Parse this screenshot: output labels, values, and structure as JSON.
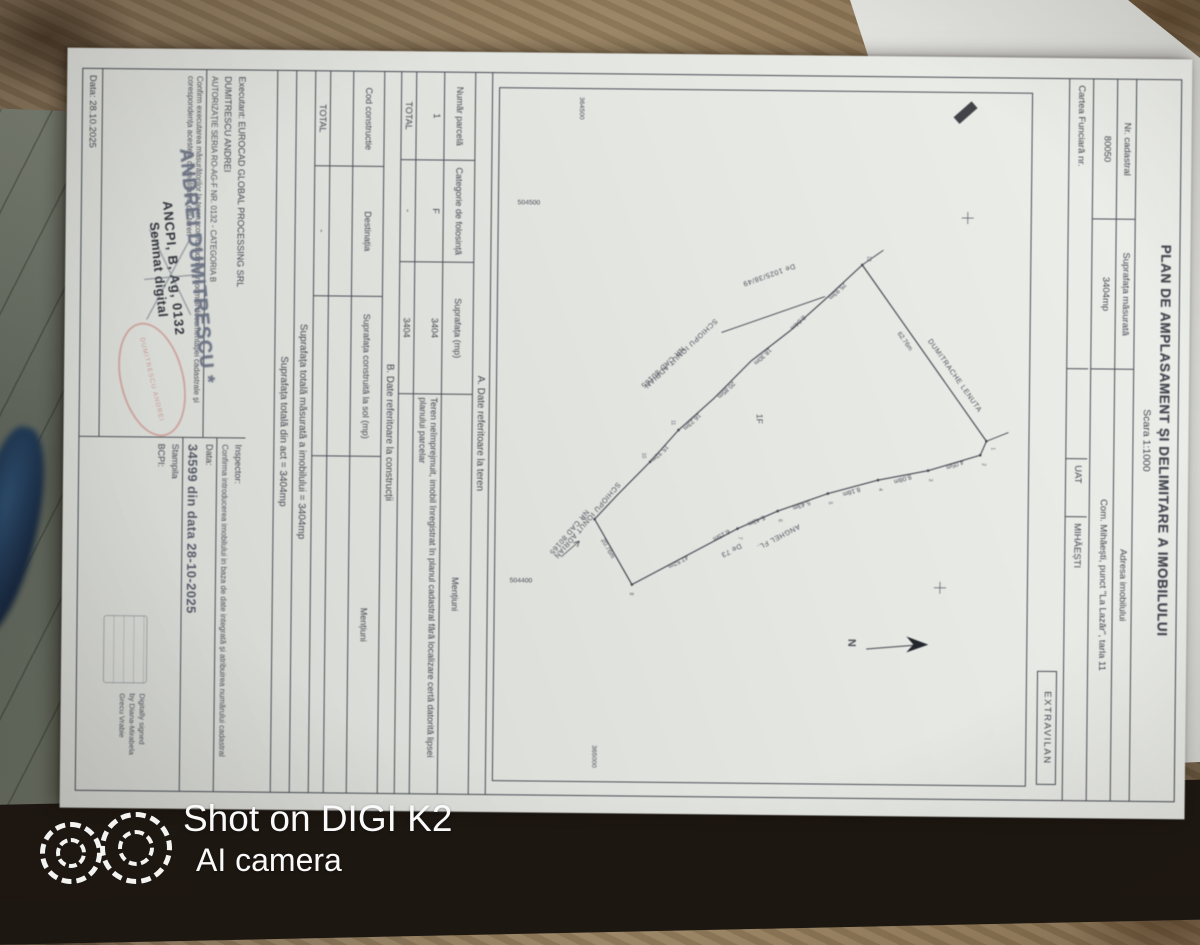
{
  "photo": {
    "watermark_line1": "Shot on DIGI K2",
    "watermark_line2": "AI  camera"
  },
  "doc": {
    "title": "PLAN DE AMPLASAMENT ȘI DELIMITARE A IMOBILULUI",
    "scale": "Scara 1:1000",
    "header": {
      "nr_cadastral_label": "Nr. cadastral",
      "nr_cadastral_value": "80050",
      "suprafata_label": "Suprafața măsurată",
      "suprafata_value": "3404mp",
      "adresa_label": "Adresa imobilului",
      "adresa_value": "Com. Mihăești, punct \"La Lazăr\", tarla 11",
      "cf_label": "Cartea Funciară nr.",
      "uat_label": "UAT",
      "uat_value": "MIHĂEȘTI",
      "zona": "EXTRAVILAN"
    },
    "plan": {
      "north": "N",
      "parcel": "1F",
      "grid_nw": "504500",
      "grid_sw": "504400",
      "grid_e": "365000",
      "grid_w": "364500",
      "road_label": "De 1025/38/49",
      "road2_label": "De 73",
      "neighbor_top": "DUMITRACHE LENUTA",
      "neighbor_left1": "SCHIOPU IONUT ADRIAN",
      "neighbor_left2": "NR CAD 80165",
      "neighbor_bottom1": "SCHIOPU IONUT ADRIAN",
      "neighbor_bottom2": "NR CAD 80165",
      "neighbor_south": "ANGHEL FL.",
      "dim_top": "62.76m",
      "dim_bottom": "20.76m",
      "dims_left": [
        "25.93m",
        "8.04m",
        "18.30m",
        "20.85m",
        "16.23m",
        "15.32m"
      ],
      "dims_right": [
        "4.05m",
        "8.08m",
        "8.18m",
        "5.43m",
        "5.43m",
        "6.15m",
        "47.52m"
      ],
      "vertex_numbers": [
        "1",
        "2",
        "3",
        "4",
        "5",
        "6",
        "7",
        "8",
        "9",
        "10",
        "11",
        "12"
      ]
    },
    "tableA": {
      "caption": "A. Date referitoare la teren",
      "col1": "Număr parcelă",
      "col2": "Categorie de folosință",
      "col3": "Suprafața (mp)",
      "col4": "Mențiuni",
      "row1_c1": "1",
      "row1_c2": "F",
      "row1_c3": "3404",
      "row1_c4": "Teren neîmprejmuit, imobil înregistrat în planul cadastral fără localizare certă datorită lipsei planului parcelar",
      "total_label": "TOTAL",
      "total_dash": "-",
      "total_value": "3404"
    },
    "tableB": {
      "caption": "B. Date referitoare la construcții",
      "col1": "Cod constructie",
      "col2": "Destinația",
      "col3": "Suprafața construită la sol (mp)",
      "col4": "Mențiuni",
      "total_label": "TOTAL",
      "total_dash": "-"
    },
    "totals": {
      "line1": "Suprafața totală măsurată a imobilului = 3404mp",
      "line2": "Suprafața totală din act = 3404mp"
    },
    "executant": {
      "line1": "Executant: EUROCAD GLOBAL PROCESSING SRL",
      "line2": "DUMITRESCU ANDREI",
      "line3": "AUTORIZAȚIE SERIA RO-AG-F NR. 0132 - CATEGORIA B",
      "confirm": "Confirm executarea măsurătorilor la teren, corectitudinea întocmirii documentației cadastrale și corespondența acesteia cu realitatea din teren",
      "date_label": "Data: 28.10.2025",
      "stamp_name": "ANDREI DUMITRESCU *",
      "stamp_line": "ANCPI, B, Ag, 0132",
      "stamp_digital": "Semnat digital",
      "red_stamp_text": "DUMITRESCU ANDREI"
    },
    "inspector": {
      "label": "Inspector:",
      "confirm": "Confirma introducerea imobilului in baza de date integrată și atribuirea numărului cadastral",
      "date_label": "Data:",
      "date_value": "34599 din data 28-10-2025",
      "stamp_label1": "Stampila",
      "stamp_label2": "BCPI:",
      "sig1": "Digitally signed",
      "sig2": "by Diana-Mirabela",
      "sig3": "Grecu Vrabie"
    }
  }
}
